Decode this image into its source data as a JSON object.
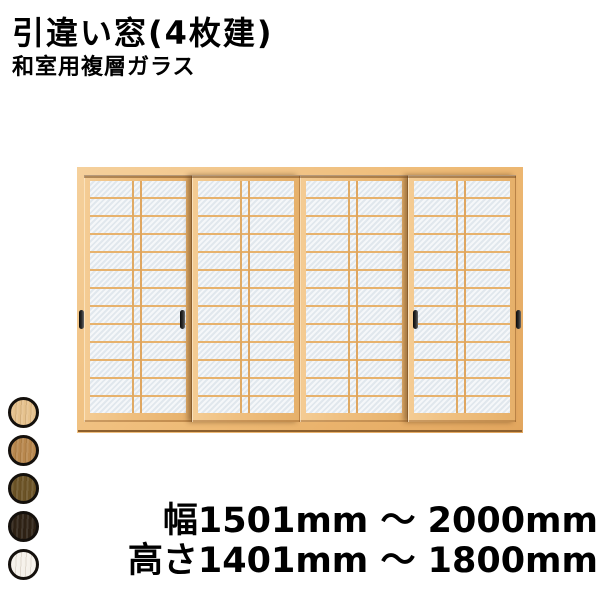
{
  "header": {
    "title": "引違い窓(4枚建)",
    "subtitle": "和室用複層ガラス"
  },
  "window_preview": {
    "description": "4-panel sliding shoji window, natural wood frame, frosted double glazing with kumiko grid",
    "panel_count": 4,
    "colors": {
      "frame": "#eeba75",
      "frame_shadow": "#b9853f",
      "glass": "#e9eef2",
      "kumiko_grid": "#e7b26d",
      "handle": "#1e1e1e"
    }
  },
  "color_swatches": [
    {
      "name": "natural-light-wood",
      "color": "#e5c18c"
    },
    {
      "name": "medium-oak-wood",
      "color": "#b8874d"
    },
    {
      "name": "dark-olive-wood",
      "color": "#6b5326"
    },
    {
      "name": "dark-brown-wood",
      "color": "#2d2115"
    },
    {
      "name": "off-white",
      "color": "#f5f1ea"
    }
  ],
  "size_info": {
    "width_range": "幅1501mm ～ 2000mm",
    "height_range": "高さ1401mm ～ 1800mm"
  }
}
